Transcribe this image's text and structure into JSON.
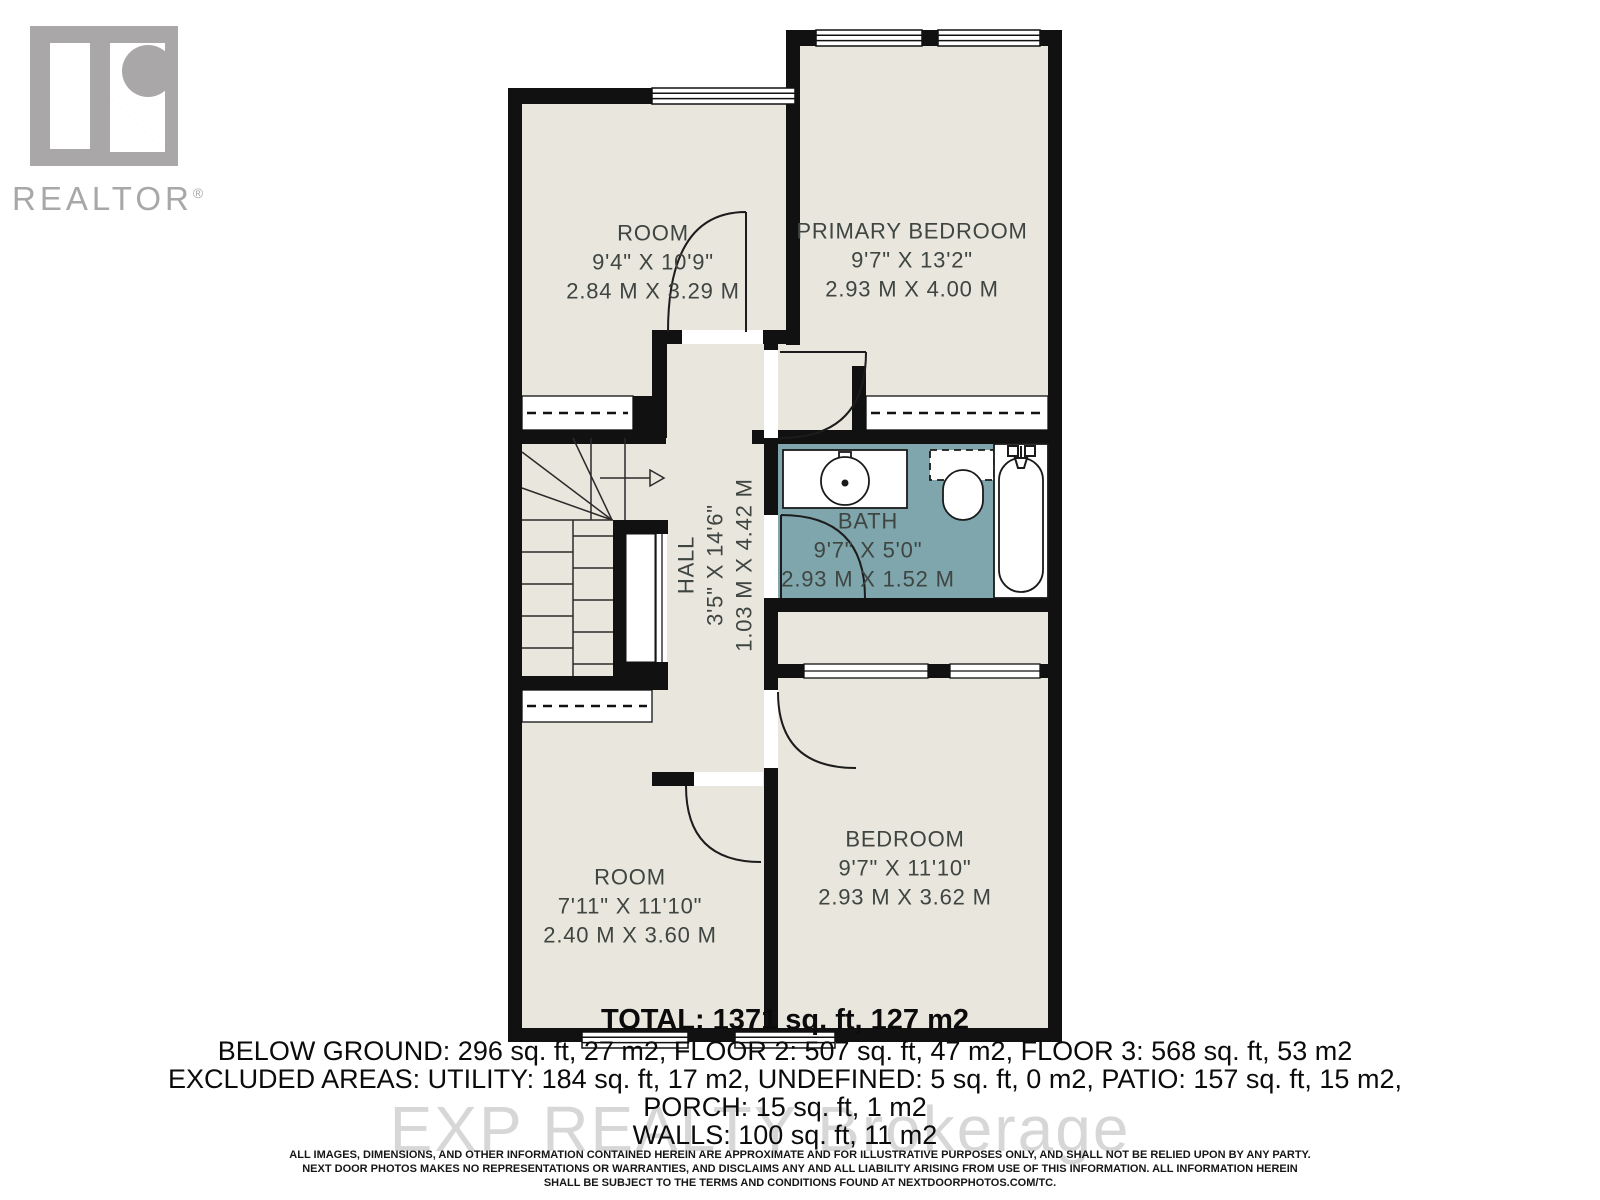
{
  "branding": {
    "logo_text": "REALTOR",
    "registered_mark": "®"
  },
  "watermark": "EXP REALTY Brokerage",
  "rooms": [
    {
      "id": "room-upper-left",
      "name": "ROOM",
      "imperial": "9'4\" X 10'9\"",
      "metric": "2.84 M X 3.29 M"
    },
    {
      "id": "primary-bedroom",
      "name": "PRIMARY BEDROOM",
      "imperial": "9'7\" X 13'2\"",
      "metric": "2.93 M X 4.00 M"
    },
    {
      "id": "bath",
      "name": "BATH",
      "imperial": "9'7\" X 5'0\"",
      "metric": "2.93 M X 1.52 M"
    },
    {
      "id": "hall",
      "name": "HALL",
      "imperial": "3'5\" X 14'6\"",
      "metric": "1.03 M X 4.42 M"
    },
    {
      "id": "room-lower-left",
      "name": "ROOM",
      "imperial": "7'11\" X 11'10\"",
      "metric": "2.40 M X 3.60 M"
    },
    {
      "id": "bedroom",
      "name": "BEDROOM",
      "imperial": "9'7\" X 11'10\"",
      "metric": "2.93 M X 3.62 M"
    }
  ],
  "summary": {
    "total": "TOTAL: 1371 sq. ft, 127 m2",
    "floors": "BELOW GROUND: 296 sq. ft, 27 m2, FLOOR 2: 507 sq. ft, 47 m2, FLOOR 3: 568 sq. ft, 53 m2",
    "excluded": "EXCLUDED AREAS: UTILITY: 184 sq. ft, 17 m2, UNDEFINED: 5 sq. ft, 0 m2, PATIO: 157 sq. ft, 15 m2,",
    "porch": "PORCH: 15 sq. ft, 1 m2",
    "walls": "WALLS: 100 sq. ft, 11 m2"
  },
  "disclaimer": [
    "ALL IMAGES, DIMENSIONS, AND OTHER INFORMATION CONTAINED HEREIN ARE APPROXIMATE AND FOR ILLUSTRATIVE PURPOSES ONLY, AND SHALL NOT BE RELIED UPON BY ANY PARTY.",
    "NEXT DOOR PHOTOS MAKES NO REPRESENTATIONS OR WARRANTIES, AND DISCLAIMS ANY AND ALL LIABILITY ARISING FROM USE OF THIS INFORMATION. ALL INFORMATION HEREIN",
    "SHALL BE SUBJECT TO THE TERMS AND CONDITIONS FOUND AT NEXTDOORPHOTOS.COM/TC."
  ],
  "colors": {
    "room_fill": "#e9e6dd",
    "bath_fill": "#7ea6ac",
    "wall": "#111111",
    "label_text": "#3f4541",
    "logo_gray": "#a9a7a8",
    "watermark_gray": "#d7d7d7"
  }
}
